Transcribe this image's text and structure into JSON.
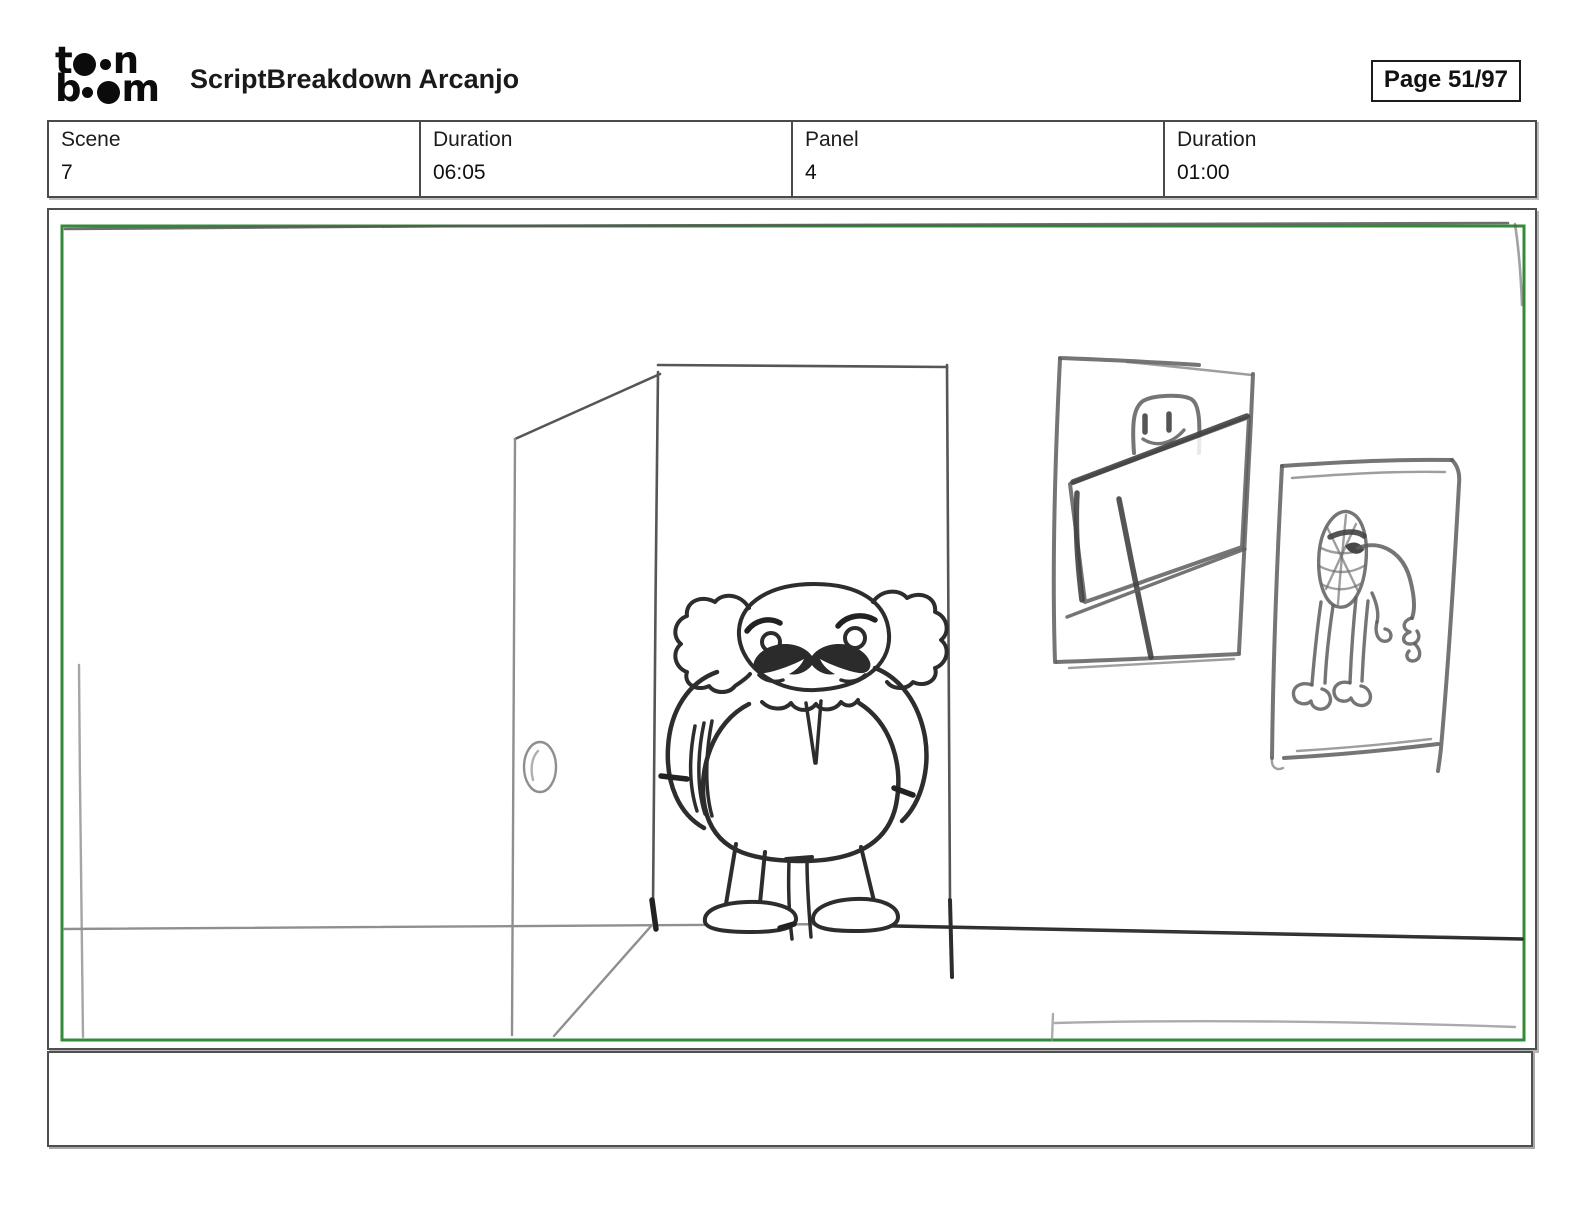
{
  "header": {
    "logo": {
      "brand": "toon boom",
      "line1": {
        "pre": "t",
        "post": "n"
      },
      "line2": {
        "pre": "b",
        "post": "m"
      }
    },
    "title": "ScriptBreakdown Arcanjo",
    "page_badge": "Page 51/97"
  },
  "info_table": {
    "cells": [
      {
        "label": "Scene",
        "value": "7"
      },
      {
        "label": "Duration",
        "value": "06:05"
      },
      {
        "label": "Panel",
        "value": "4"
      },
      {
        "label": "Duration",
        "value": "01:00"
      }
    ]
  },
  "storyboard_panel": {
    "camera_frame_color": "#35893a",
    "sketch_ink_color": "#2d2d2d",
    "construction_line_color": "#8f8f8f",
    "description": "Rough pencil storyboard sketch: a short bald man with bushy side hair and a big handlebar mustache stands in an open doorway, hands behind his back; an open door with a round knob swings to the left; two crooked framed pictures hang on the right wall (a stick figure holding a tilted board, and a creature with a Spider-Man mask); a horizon floor line runs across the room."
  },
  "caption": {
    "text": ""
  }
}
